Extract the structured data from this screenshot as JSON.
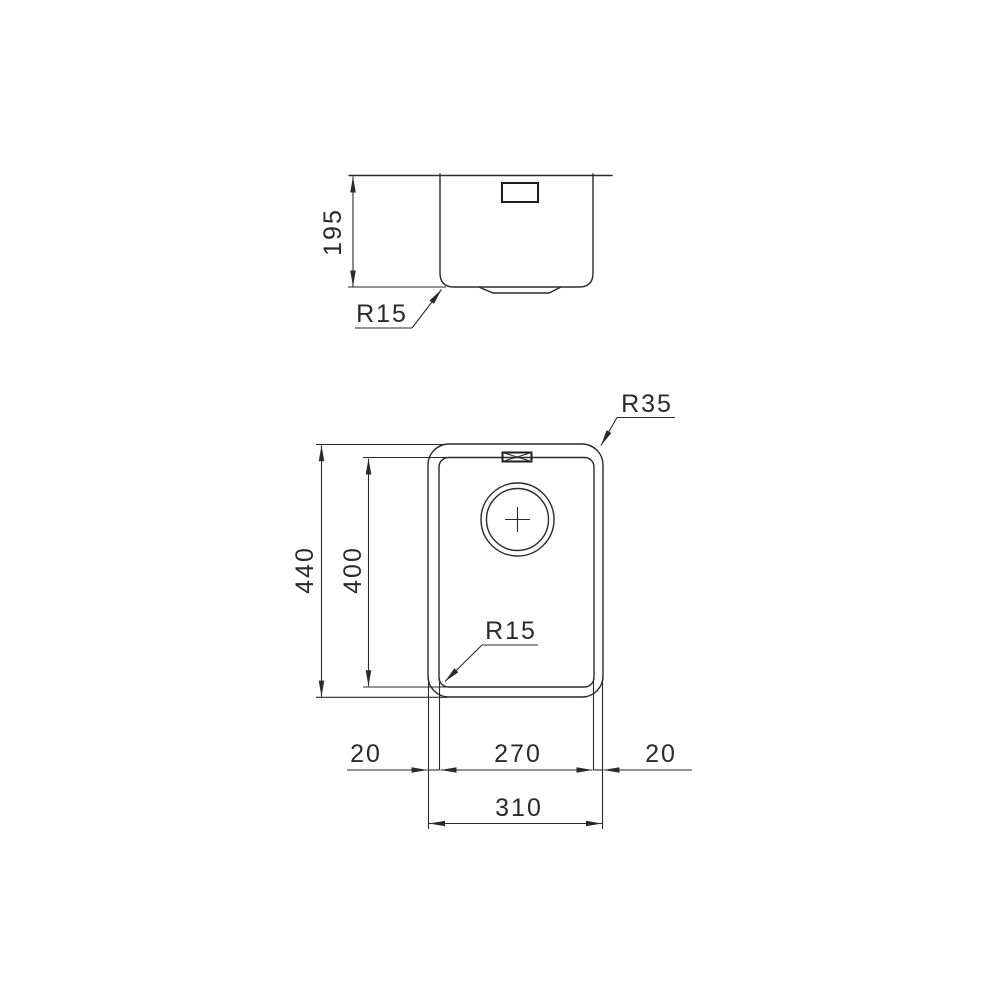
{
  "drawing": {
    "background_color": "#ffffff",
    "line_color": "#2a2a2a",
    "side_view": {
      "height_dim": "195",
      "bottom_radius_label": "R15"
    },
    "plan_view": {
      "overall_height_dim": "440",
      "bowl_height_dim": "400",
      "outer_corner_radius_label": "R35",
      "bowl_corner_radius_label": "R15",
      "left_rim_dim": "20",
      "bowl_width_dim": "270",
      "right_rim_dim": "20",
      "overall_width_dim": "310"
    }
  }
}
